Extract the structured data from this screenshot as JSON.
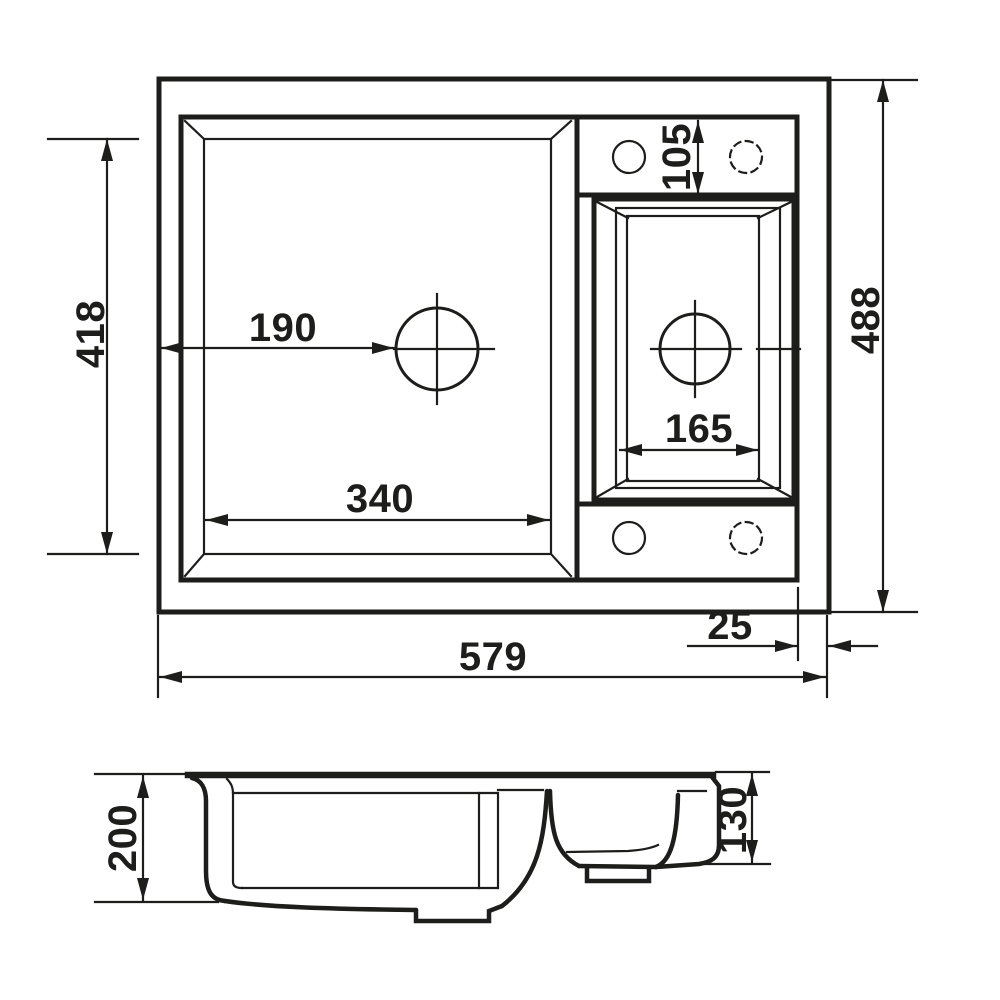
{
  "drawing": {
    "subject": "sink-dimension-drawing",
    "units": "mm",
    "colors": {
      "line": "#1d1d1b",
      "background": "#ffffff"
    },
    "top_view": {
      "overall_width": "579",
      "overall_depth": "488",
      "main_bowl_width": "340",
      "main_bowl_depth": "418",
      "drain_offset_left": "190",
      "small_bowl_width": "165",
      "tap_ledge_depth": "105",
      "right_edge_margin": "25"
    },
    "side_view": {
      "main_bowl_height": "200",
      "small_bowl_height": "130"
    }
  }
}
